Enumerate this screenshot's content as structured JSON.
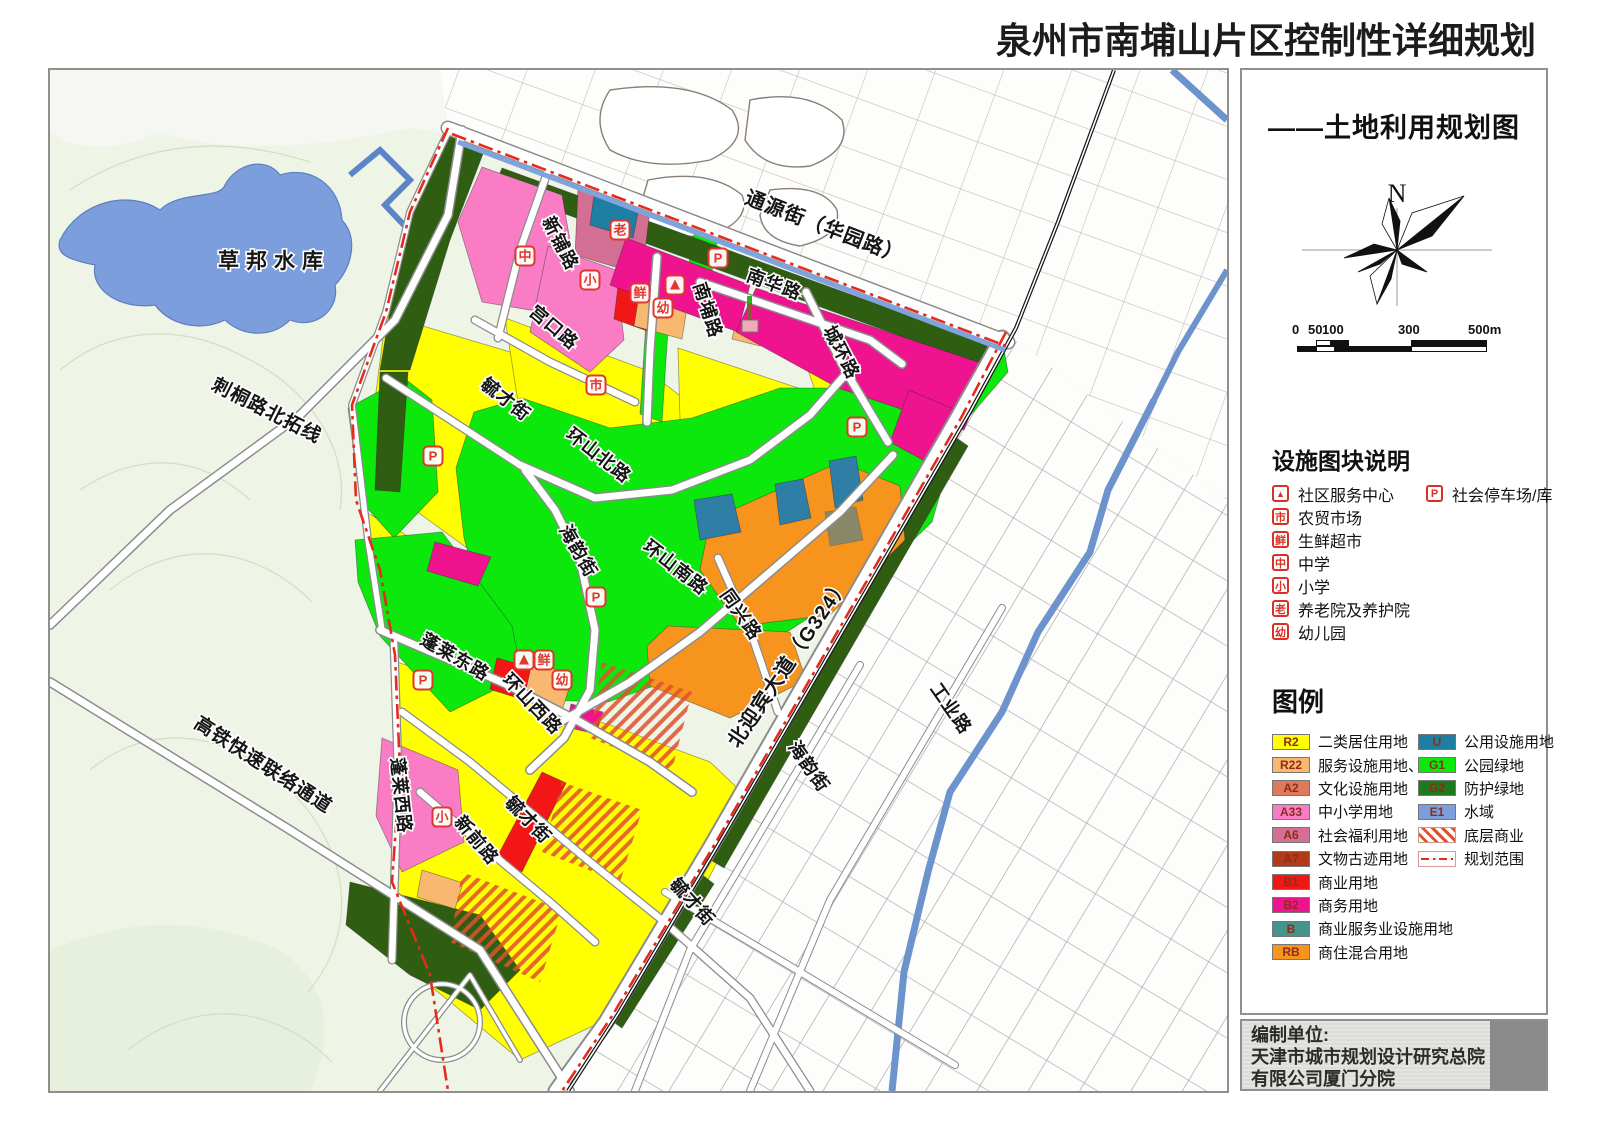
{
  "page": {
    "title": "泉州市南埔山片区控制性详细规划",
    "subtitle": "——土地利用规划图"
  },
  "compass": {
    "label": "N"
  },
  "scale_bar": {
    "labels": [
      "0",
      "50",
      "100",
      "300",
      "500m"
    ]
  },
  "facility_legend": {
    "heading": "设施图块说明",
    "items": [
      {
        "symbol": "▲",
        "label": "社区服务中心"
      },
      {
        "symbol": "P",
        "label": "社会停车场/库"
      },
      {
        "symbol": "市",
        "label": "农贸市场"
      },
      {
        "symbol": "鲜",
        "label": "生鲜超市"
      },
      {
        "symbol": "中",
        "label": "中学"
      },
      {
        "symbol": "小",
        "label": "小学"
      },
      {
        "symbol": "老",
        "label": "养老院及养护院"
      },
      {
        "symbol": "幼",
        "label": "幼儿园"
      }
    ]
  },
  "landuse_legend": {
    "heading": "图例",
    "left": [
      {
        "code": "R2",
        "color": "#ffff00",
        "label": "二类居住用地"
      },
      {
        "code": "R22",
        "color": "#f9b870",
        "label": "服务设施用地、"
      },
      {
        "code": "A2",
        "color": "#e0795b",
        "label": "文化设施用地"
      },
      {
        "code": "A33",
        "color": "#fa7cc4",
        "label": "中小学用地"
      },
      {
        "code": "A6",
        "color": "#d26f93",
        "label": "社会福利用地"
      },
      {
        "code": "A7",
        "color": "#b33a16",
        "label": "文物古迹用地"
      },
      {
        "code": "B1",
        "color": "#f21616",
        "label": "商业用地"
      },
      {
        "code": "B2",
        "color": "#f0138f",
        "label": "商务用地"
      },
      {
        "code": "B",
        "color": "#43948a",
        "label": "商业服务业设施用地"
      },
      {
        "code": "RB",
        "color": "#f7941e",
        "label": "商住混合用地"
      }
    ],
    "right": [
      {
        "code": "U",
        "color": "#1f7fa3",
        "label": "公用设施用地"
      },
      {
        "code": "G1",
        "color": "#0ce80c",
        "label": "公园绿地"
      },
      {
        "code": "G2",
        "color": "#1f7a1f",
        "label": "防护绿地"
      },
      {
        "code": "E1",
        "color": "#7d9edc",
        "label": "水域"
      },
      {
        "type": "hatch",
        "label": "底层商业"
      },
      {
        "type": "boundary",
        "label": "规划范围"
      }
    ]
  },
  "attribution": {
    "line1": "编制单位:",
    "line2": "天津市城市规划设计研究总院",
    "line3": "有限公司厦门分院"
  },
  "map": {
    "labels": [
      {
        "t": "草邦水库",
        "x": 224,
        "y": 198,
        "r": 0,
        "s": 21,
        "ls": 7
      },
      {
        "t": "刺桐路北拓线",
        "x": 214,
        "y": 346,
        "r": 27,
        "s": 19
      },
      {
        "t": "高铁快速联络通道",
        "x": 210,
        "y": 700,
        "r": 33,
        "s": 19
      },
      {
        "t": "通源街（华园路）",
        "x": 772,
        "y": 163,
        "r": 21,
        "s": 20
      },
      {
        "t": "新铺路",
        "x": 505,
        "y": 176,
        "r": 63
      },
      {
        "t": "宫口路",
        "x": 500,
        "y": 262,
        "r": 40
      },
      {
        "t": "毓才街",
        "x": 452,
        "y": 334,
        "r": 38
      },
      {
        "t": "环山北路",
        "x": 545,
        "y": 390,
        "r": 38
      },
      {
        "t": "海韵街",
        "x": 523,
        "y": 484,
        "r": 60
      },
      {
        "t": "环山南路",
        "x": 622,
        "y": 502,
        "r": 38
      },
      {
        "t": "南埔路",
        "x": 652,
        "y": 242,
        "r": 72
      },
      {
        "t": "南华路",
        "x": 722,
        "y": 220,
        "r": 20
      },
      {
        "t": "城环路",
        "x": 786,
        "y": 285,
        "r": 63
      },
      {
        "t": "同兴路",
        "x": 686,
        "y": 548,
        "r": 55
      },
      {
        "t": "北迎宾大道（G324）",
        "x": 744,
        "y": 596,
        "r": -56,
        "s": 20
      },
      {
        "t": "海韵街",
        "x": 754,
        "y": 700,
        "r": 55
      },
      {
        "t": "工业路",
        "x": 896,
        "y": 642,
        "r": 55
      },
      {
        "t": "毓才街",
        "x": 638,
        "y": 836,
        "r": 48
      },
      {
        "t": "蓬莱东路",
        "x": 402,
        "y": 592,
        "r": 30
      },
      {
        "t": "环山西路",
        "x": 478,
        "y": 638,
        "r": 46
      },
      {
        "t": "毓才街",
        "x": 474,
        "y": 754,
        "r": 46
      },
      {
        "t": "蓬莱西路",
        "x": 345,
        "y": 726,
        "r": 84
      },
      {
        "t": "新前路",
        "x": 422,
        "y": 774,
        "r": 50
      }
    ],
    "markers": [
      {
        "c": "中",
        "x": 475,
        "y": 186
      },
      {
        "c": "老",
        "x": 570,
        "y": 160
      },
      {
        "c": "小",
        "x": 540,
        "y": 210
      },
      {
        "c": "鲜",
        "x": 590,
        "y": 223
      },
      {
        "c": "▲",
        "x": 625,
        "y": 215
      },
      {
        "c": "幼",
        "x": 613,
        "y": 238
      },
      {
        "c": "P",
        "x": 668,
        "y": 188
      },
      {
        "c": "市",
        "x": 546,
        "y": 315
      },
      {
        "c": "P",
        "x": 383,
        "y": 386
      },
      {
        "c": "P",
        "x": 807,
        "y": 357
      },
      {
        "c": "P",
        "x": 546,
        "y": 527
      },
      {
        "c": "▲",
        "x": 474,
        "y": 590
      },
      {
        "c": "鲜",
        "x": 494,
        "y": 590
      },
      {
        "c": "幼",
        "x": 512,
        "y": 610
      },
      {
        "c": "P",
        "x": 373,
        "y": 610
      },
      {
        "c": "小",
        "x": 392,
        "y": 747
      }
    ]
  }
}
